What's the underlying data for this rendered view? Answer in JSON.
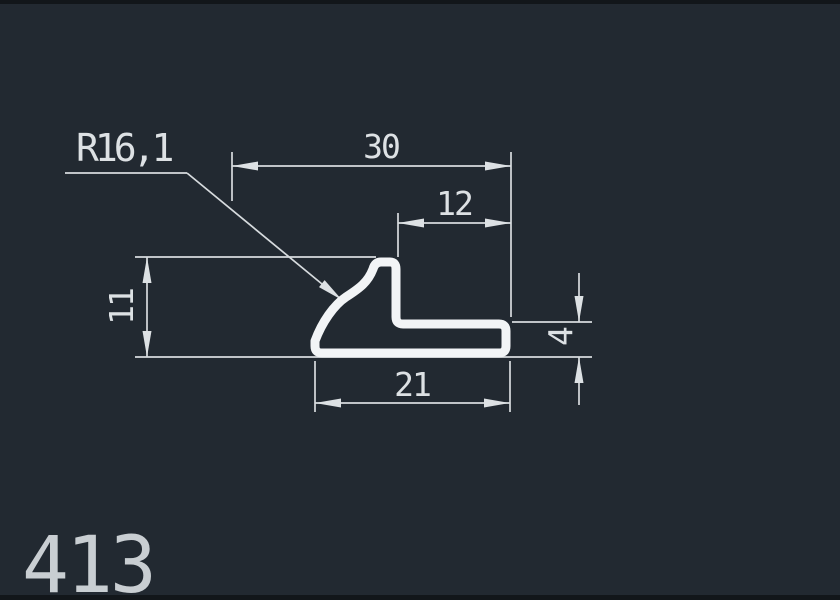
{
  "canvas": {
    "background_color": "#222931",
    "frame_edge_color": "#12161a",
    "line_color": "#d7dbde",
    "profile_stroke_color": "#f2f4f6",
    "text_color": "#dde1e4",
    "part_number_color": "#c9ced2"
  },
  "drawing": {
    "part_number": "413",
    "radius_callout": {
      "label": "R16,1",
      "type": "radius-leader"
    },
    "dimensions": [
      {
        "label": "30",
        "orientation": "horizontal",
        "position": "top"
      },
      {
        "label": "12",
        "orientation": "horizontal",
        "position": "upper"
      },
      {
        "label": "11",
        "orientation": "vertical",
        "position": "left"
      },
      {
        "label": "4",
        "orientation": "vertical",
        "position": "right"
      },
      {
        "label": "21",
        "orientation": "horizontal",
        "position": "bottom"
      }
    ],
    "shape": "L-profile cross-section with concave radius on left flank"
  }
}
